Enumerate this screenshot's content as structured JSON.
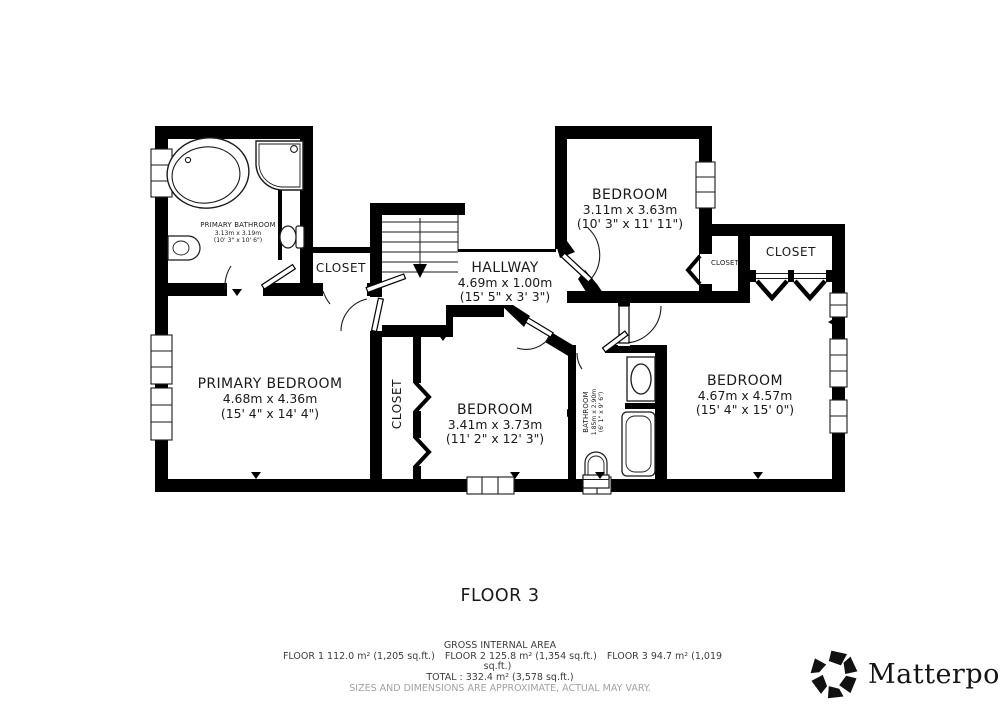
{
  "floor_label": "FLOOR 3",
  "rooms": {
    "primary_bathroom": {
      "name": "PRIMARY BATHROOM",
      "metric": "3.13m x 3.19m",
      "imperial": "(10' 3\" x 10' 6\")"
    },
    "hallway": {
      "name": "HALLWAY",
      "metric": "4.69m x 1.00m",
      "imperial": "(15' 5\" x 3' 3\")"
    },
    "bedroom_top": {
      "name": "BEDROOM",
      "metric": "3.11m x 3.63m",
      "imperial": "(10' 3\" x 11' 11\")"
    },
    "primary_bedroom": {
      "name": "PRIMARY BEDROOM",
      "metric": "4.68m x 4.36m",
      "imperial": "(15' 4\" x 14' 4\")"
    },
    "bedroom_middle": {
      "name": "BEDROOM",
      "metric": "3.41m x 3.73m",
      "imperial": "(11' 2\" x 12' 3\")"
    },
    "bedroom_right": {
      "name": "BEDROOM",
      "metric": "4.67m x 4.57m",
      "imperial": "(15' 4\" x 15' 0\")"
    },
    "bathroom": {
      "name": "BATHROOM",
      "metric": "1.85m x 2.90m",
      "imperial": "(6' 1\" x 9' 6\")"
    },
    "closet_by_bathroom": {
      "name": "CLOSET"
    },
    "closet_small": {
      "name": "CLOSET"
    },
    "closet_top_right": {
      "name": "CLOSET"
    },
    "closet_primary": {
      "name": "CLOSET"
    }
  },
  "footer": {
    "title": "GROSS INTERNAL AREA",
    "floor1": "FLOOR 1 112.0 m² (1,205 sq.ft.)",
    "floor2": "FLOOR 2 125.8 m² (1,354 sq.ft.)",
    "floor3": "FLOOR 3 94.7 m² (1,019 sq.ft.)",
    "total": "TOTAL :  332.4 m² (3,578 sq.ft.)",
    "disclaimer": "SIZES AND DIMENSIONS ARE APPROXIMATE, ACTUAL MAY VARY."
  },
  "brand": {
    "name": "Matterport",
    "mark": "®"
  },
  "colors": {
    "wall": "#000000",
    "text": "#1a1a1a",
    "muted": "#a2a2a2"
  }
}
